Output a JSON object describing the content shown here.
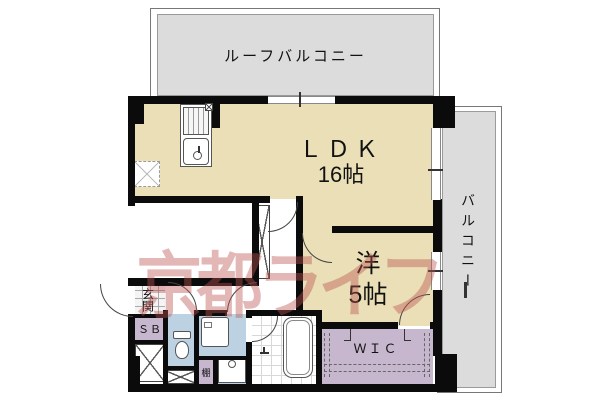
{
  "watermark": {
    "text": "京都ライフ"
  },
  "areas": {
    "roof_balcony": {
      "label": "ルーフバルコニー"
    },
    "balcony": {
      "label": "バルコニー"
    },
    "ldk": {
      "label": "ＬＤＫ",
      "size": "16帖"
    },
    "western_room": {
      "label": "洋",
      "size": "5帖"
    },
    "entrance": {
      "label": "玄関"
    },
    "shoe_box": {
      "label": "ＳＢ"
    },
    "wic": {
      "label": "ＷＩＣ"
    },
    "shelf": {
      "label": "棚"
    }
  },
  "colors": {
    "room_floor": "#EADFB6",
    "balcony_floor": "#DCDCDC",
    "wet_area_floor": "#BCD2E2",
    "storage_floor": "#C7B7CE",
    "wall": "#0B0B0B",
    "watermark": "rgba(186,84,78,0.42)"
  }
}
